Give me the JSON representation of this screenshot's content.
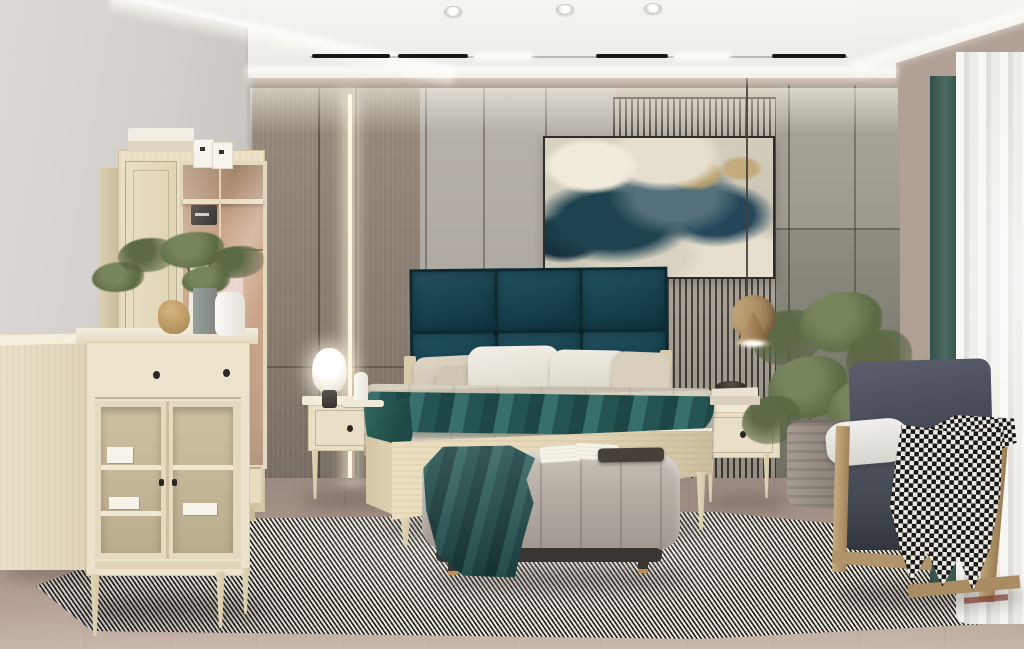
{
  "meta": {
    "type": "interior-photograph",
    "room": "bedroom",
    "style": "modern light-wood with teal accents",
    "visible_text": "none"
  },
  "palette": {
    "wood-dark-panel": "#968a7d",
    "wall-gray": "#b7b2ab",
    "slat-dark": "#403d36",
    "slat-light": "#b4ab9d",
    "teal-1": "#23525f",
    "teal-2": "#16414d",
    "wood-light": "#ecdfc0",
    "duvet": "#d8d1c2",
    "throw-teal": "#2f625e",
    "bench": "#b4aca3",
    "floor-1": "#9b8a82",
    "rug-dark": "#23221f",
    "rug-light": "#e8e4da",
    "curtain-gray": "#7e807b",
    "curtain-teal": "#4b6a60",
    "sheer": "#f7f7f4",
    "chair-body": "#474c57",
    "chair-wood": "#c0a379",
    "hound-dark": "#171715",
    "hound-light": "#ece9e2",
    "brass": "#c4a276"
  },
  "labels": {
    "scene": "Modern bedroom with light wood furniture, teal headboard and abstract wall art",
    "bed": "Bed with dark teal panelled headboard, beige quilted duvet and teal runner",
    "wardrobe": "Light wood wardrobe with glass door showing hanging clothes and storage boxes on top",
    "dresser": "Cream dresser with drawer and glass display doors",
    "sideboard": "Low cream sideboard at left wall",
    "bench": "Upholstered channel-tufted bench with teal throw and open book",
    "armchair": "Dark grey armchair with bent wood frame and houndstooth throw",
    "nightstand_left": "Left nightstand with glowing table lamp and candle",
    "nightstand_right": "Right nightstand with stacked books and bowl",
    "pendant": "Brass cone pendant lamp on thin cord",
    "painting": "Abstract teal and cream marble artwork in black frame",
    "curtains": "Grey and teal drapes with white sheer curtains",
    "rug": "Large black and white woven rug",
    "plant_right": "Potted green plant beside armchair",
    "plant_dresser": "Leafy branches in vases on dresser",
    "ceiling": "Recessed cove ceiling with track lights and spotlights"
  }
}
